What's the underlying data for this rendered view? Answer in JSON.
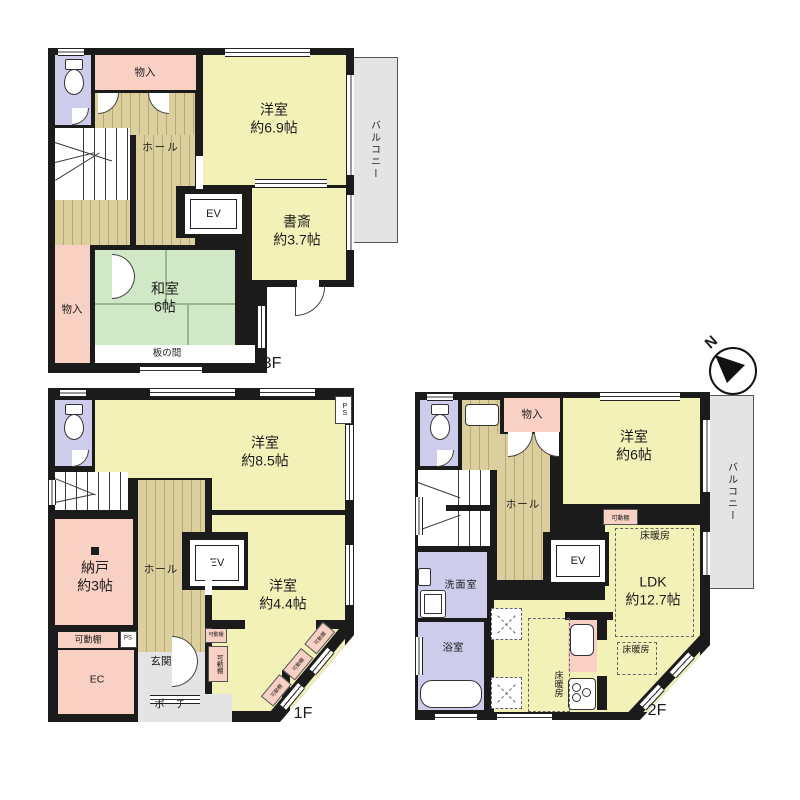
{
  "palette": {
    "wall": "#1b1b1b",
    "room_yellow": "#f2f1b8",
    "room_green": "#d0e8c6",
    "room_pink": "#f9d0c4",
    "room_lavender": "#cdcdeb",
    "wood_floor": "#dccf9e",
    "balcony_gray": "#e4e4e4"
  },
  "compass": {
    "north_label": "N"
  },
  "floor3": {
    "floor_label": "3F",
    "balcony": "バルコニー",
    "rooms": {
      "monoire_top": "物入",
      "hall": "ホール",
      "yoshitsu": {
        "name": "洋室",
        "size": "約6.9帖"
      },
      "ev": "EV",
      "shosai": {
        "name": "書斎",
        "size": "約3.7帖"
      },
      "washitsu": {
        "name": "和室",
        "size": "6帖"
      },
      "monoire_left": "物入",
      "itanoma": "板の間"
    }
  },
  "floor1": {
    "floor_label": "1F",
    "rooms": {
      "yoshitsu_85": {
        "name": "洋室",
        "size": "約8.5帖"
      },
      "ps_corner": "PS",
      "nando": {
        "name": "納戸",
        "size": "約3帖"
      },
      "hall": "ホール",
      "ev": "EV",
      "yoshitsu_44": {
        "name": "洋室",
        "size": "約4.4帖"
      },
      "kadoudana_shelf": "可動棚",
      "ps_small": "PS",
      "ec": "EC",
      "genkan": "玄関",
      "porch": "ポーチ",
      "kadoudana_v1": "可動棚",
      "kadoudana_v2": "可動棚",
      "kadoudana_diag": [
        "可動棚",
        "可動棚",
        "可動棚"
      ]
    }
  },
  "floor2": {
    "floor_label": "2F",
    "balcony": "バルコニー",
    "rooms": {
      "monoire": "物入",
      "yoshitsu_6": {
        "name": "洋室",
        "size": "約6帖"
      },
      "hall": "ホール",
      "ev": "EV",
      "kadoudana": "可動棚",
      "ldk": {
        "name": "LDK",
        "size": "約12.7帖"
      },
      "yukadanbo_top": "床暖房",
      "yukadanbo_mid": "床暖房",
      "yukadanbo_left": "床暖房",
      "senmenshitsu": "洗面室",
      "yokushitsu": "浴室"
    }
  }
}
